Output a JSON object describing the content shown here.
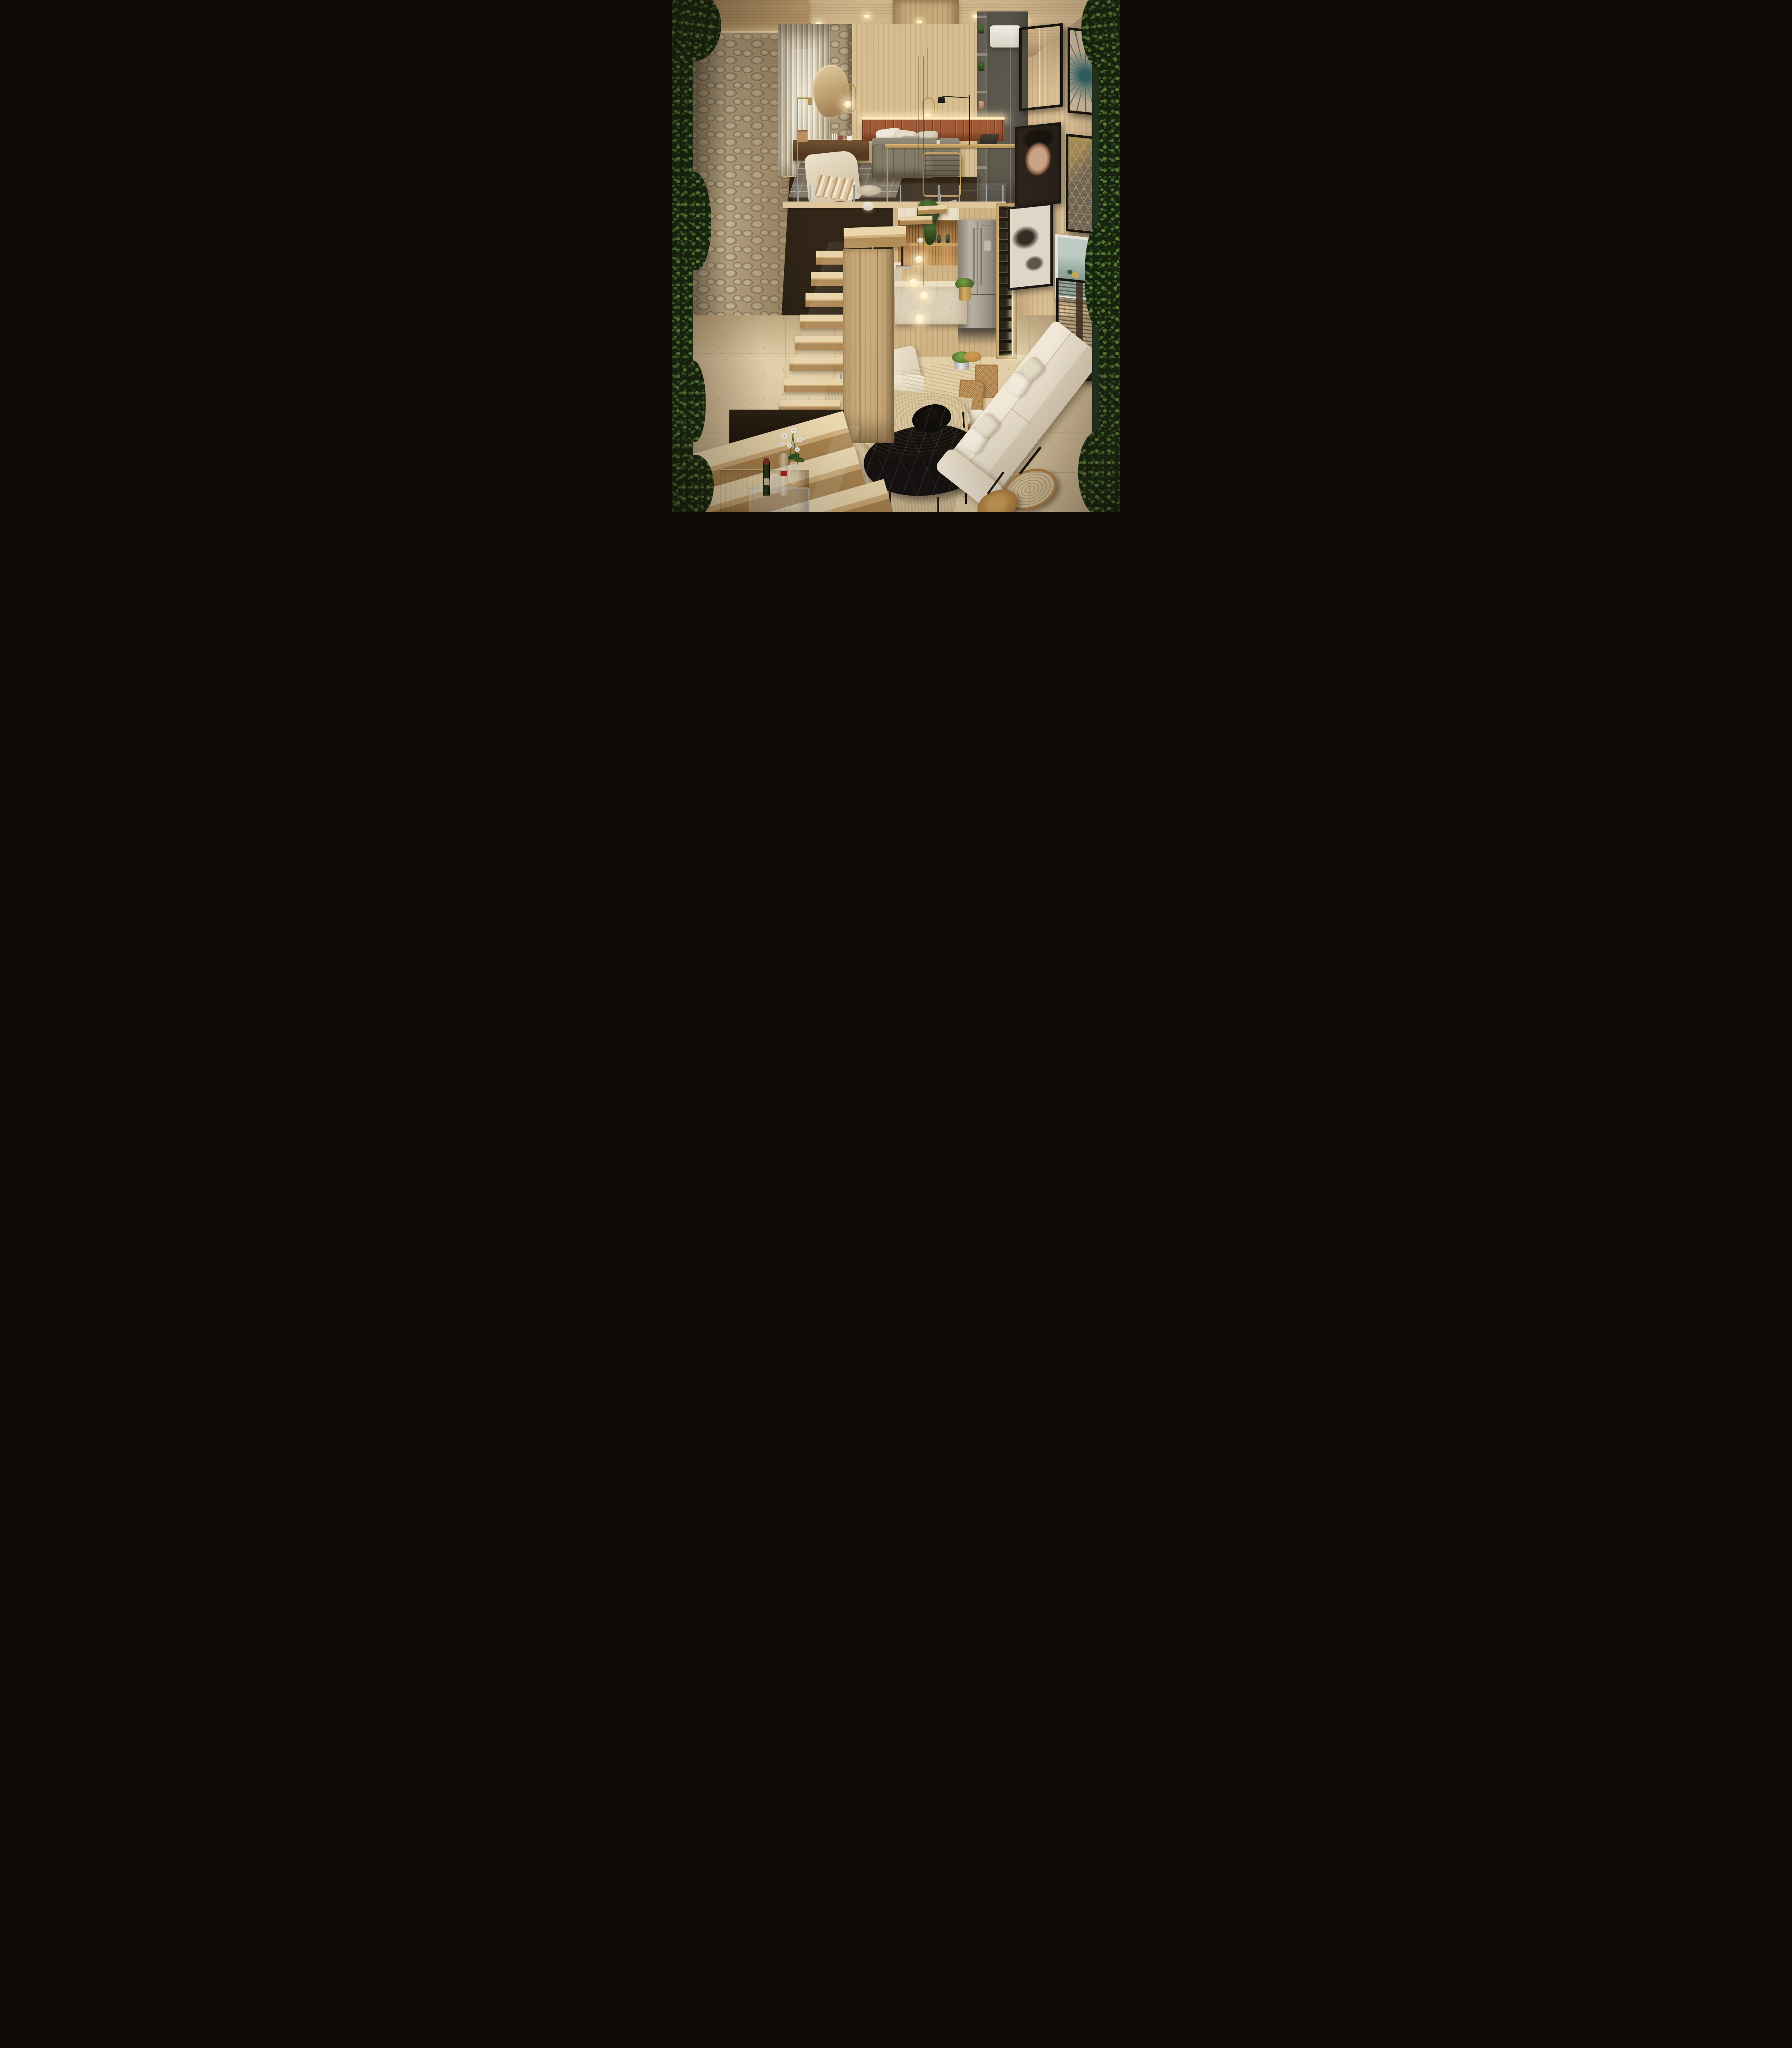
{
  "meta": {
    "title": "Compact loft apartment - photoreal interior render",
    "view": "elevated wide-angle view from mezzanine level looking across double-height living space",
    "style": "warm contemporary wood-and-stone loft with vertical gardens"
  },
  "palette": {
    "wood_light": "#d6ba8e",
    "wood_mid": "#c2a272",
    "wood_deep": "#a07a48",
    "wood_dark": "#6f5231",
    "ceiling": "#cdb289",
    "stone": "#b2a07e",
    "marble": "#eadfc8",
    "travertine": "#e2cfa9",
    "rug": "#d8c5a0",
    "sofa": "#ece2d0",
    "headboard": "#9c5130",
    "leather": "#a98a56",
    "fridge": "#a29c93",
    "grey_cabinet": "#57534b",
    "frame_black": "#16130f",
    "green_dark": "#16240f",
    "green_mid": "#35522a",
    "green_light": "#5d8136",
    "glow": "#ffe9bb",
    "metal": "#9aa0a6"
  },
  "appliances": {
    "fridge_brand": "Brastemp"
  },
  "scene": {
    "zones": [
      "mezzanine bedroom with home office",
      "kitchen with island and wine column",
      "dining nook with banquette",
      "double-height living room",
      "floating oak staircase",
      "bar counter under stairs"
    ],
    "objects": [
      "stone feature wall",
      "sheer curtained window",
      "pebble-shaped mirror",
      "brass oval pendant lights",
      "terracotta channel-tufted headboard",
      "grey upholstered bed",
      "cream wingback armchair",
      "brass floor lamp",
      "gold-frame desk with tan leather office chair",
      "black task lamp",
      "grey bookcase with plants",
      "white AC unit",
      "wood-slat backsplash with lit shelf",
      "stainless french-door refrigerator",
      "marble island with glowing globe pendants",
      "hanging pothos plant",
      "LED-lit wine rack column",
      "live-edge dining table with cone pedestal",
      "cane-back dining chairs",
      "cream banquette",
      "gallery wall with seven framed artworks",
      "cream fabric sofa with pillows",
      "organic wood and black-marble nesting coffee tables",
      "round wood tray side tables",
      "ribbed beige rug",
      "travertine floor",
      "floating wood stair treads with glass balustrade",
      "bar tray with wine bottles, decanter and white orchid",
      "fern and prayer-plant vertical gardens"
    ],
    "artworks": [
      "sepia feather print",
      "teal dandelion macro photo",
      "portrait of girl with closed eyes",
      "gold geometric lattice print",
      "black and white butterfly study",
      "white-framed botanical still life",
      "sepia city skyscraper photo"
    ]
  }
}
